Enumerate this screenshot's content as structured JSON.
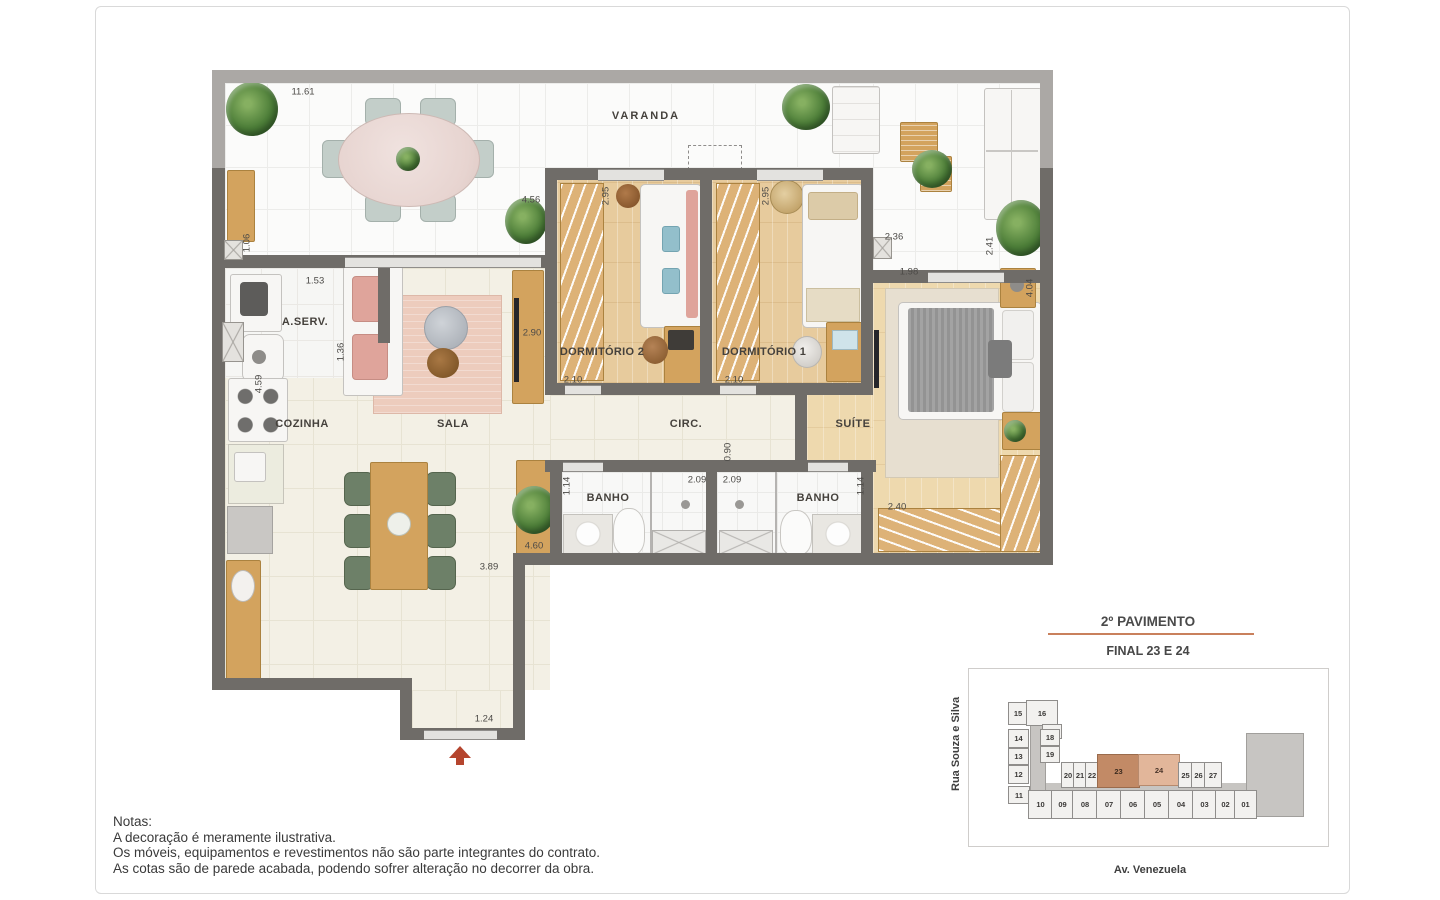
{
  "colors": {
    "wall": "#6f6c68",
    "parapet": "#aba8a5",
    "accent_underline": "#c9805c",
    "unit_dark": "#c28a66",
    "unit_light": "#e2b69a",
    "entry_arrow": "#b5452e"
  },
  "plan": {
    "room_labels": [
      {
        "id": "varanda",
        "text": "VARANDA",
        "x": 646,
        "y": 116,
        "ls": 2
      },
      {
        "id": "aserv",
        "text": "A.SERV.",
        "x": 305,
        "y": 322,
        "ls": 0.5
      },
      {
        "id": "cozinha",
        "text": "COZINHA",
        "x": 302,
        "y": 424,
        "ls": 0.5
      },
      {
        "id": "sala",
        "text": "SALA",
        "x": 453,
        "y": 424,
        "ls": 0.5
      },
      {
        "id": "dormitorio-2",
        "text": "DORMITÓRIO 2",
        "x": 602,
        "y": 352,
        "ls": 0.3
      },
      {
        "id": "dormitorio-1",
        "text": "DORMITÓRIO 1",
        "x": 764,
        "y": 352,
        "ls": 0.3
      },
      {
        "id": "circ",
        "text": "CIRC.",
        "x": 686,
        "y": 424,
        "ls": 0.5
      },
      {
        "id": "suite",
        "text": "SUÍTE",
        "x": 853,
        "y": 424,
        "ls": 0.5
      },
      {
        "id": "banho-1",
        "text": "BANHO",
        "x": 608,
        "y": 498,
        "ls": 0.5
      },
      {
        "id": "banho-2",
        "text": "BANHO",
        "x": 818,
        "y": 498,
        "ls": 0.5
      }
    ],
    "dimensions": [
      {
        "text": "11.61",
        "x": 303,
        "y": 92,
        "v": false
      },
      {
        "text": "4.56",
        "x": 531,
        "y": 200,
        "v": false
      },
      {
        "text": "1.06",
        "x": 247,
        "y": 243,
        "v": true
      },
      {
        "text": "1.53",
        "x": 315,
        "y": 281,
        "v": false
      },
      {
        "text": "1.36",
        "x": 341,
        "y": 352,
        "v": true
      },
      {
        "text": "4.59",
        "x": 259,
        "y": 384,
        "v": true
      },
      {
        "text": "2.90",
        "x": 532,
        "y": 333,
        "v": false
      },
      {
        "text": "2.95",
        "x": 606,
        "y": 196,
        "v": true
      },
      {
        "text": "2.95",
        "x": 766,
        "y": 196,
        "v": true
      },
      {
        "text": "2.10",
        "x": 573,
        "y": 380,
        "v": false
      },
      {
        "text": "2.10",
        "x": 734,
        "y": 380,
        "v": false
      },
      {
        "text": "2.36",
        "x": 894,
        "y": 237,
        "v": false
      },
      {
        "text": "2.41",
        "x": 990,
        "y": 246,
        "v": true
      },
      {
        "text": "1.98",
        "x": 909,
        "y": 272,
        "v": false
      },
      {
        "text": "4.04",
        "x": 1030,
        "y": 288,
        "v": true
      },
      {
        "text": "0.90",
        "x": 728,
        "y": 452,
        "v": true
      },
      {
        "text": "1.14",
        "x": 567,
        "y": 486,
        "v": true
      },
      {
        "text": "2.09",
        "x": 697,
        "y": 480,
        "v": false
      },
      {
        "text": "2.09",
        "x": 732,
        "y": 480,
        "v": false
      },
      {
        "text": "1.14",
        "x": 861,
        "y": 486,
        "v": true
      },
      {
        "text": "2.40",
        "x": 897,
        "y": 507,
        "v": false
      },
      {
        "text": "4.60",
        "x": 534,
        "y": 546,
        "v": false
      },
      {
        "text": "3.89",
        "x": 489,
        "y": 567,
        "v": false
      },
      {
        "text": "1.24",
        "x": 484,
        "y": 719,
        "v": false
      }
    ]
  },
  "notes": {
    "title": "Notas:",
    "lines": [
      "A decoração é meramente ilustrativa.",
      "Os móveis, equipamentos e revestimentos não são parte integrantes do contrato.",
      "As cotas são de parede acabada, podendo sofrer alteração no decorrer da obra."
    ]
  },
  "keyplan": {
    "title": "2º PAVIMENTO",
    "subtitle": "FINAL 23 E 24",
    "street_left": "Rua Souza e Silva",
    "street_bottom": "Av. Venezuela",
    "units": [
      {
        "label": "15",
        "x": 1008,
        "y": 702,
        "w": 18,
        "h": 21
      },
      {
        "label": "16",
        "x": 1026,
        "y": 700,
        "w": 30,
        "h": 24
      },
      {
        "label": "17",
        "x": 1042,
        "y": 724,
        "w": 18,
        "h": 13
      },
      {
        "label": "14",
        "x": 1008,
        "y": 729,
        "w": 19,
        "h": 17
      },
      {
        "label": "18",
        "x": 1040,
        "y": 729,
        "w": 18,
        "h": 15
      },
      {
        "label": "13",
        "x": 1008,
        "y": 748,
        "w": 19,
        "h": 15
      },
      {
        "label": "19",
        "x": 1040,
        "y": 746,
        "w": 18,
        "h": 15
      },
      {
        "label": "12",
        "x": 1008,
        "y": 765,
        "w": 19,
        "h": 17
      },
      {
        "label": "11",
        "x": 1008,
        "y": 786,
        "w": 20,
        "h": 16
      },
      {
        "label": "20",
        "x": 1061,
        "y": 762,
        "w": 12,
        "h": 24
      },
      {
        "label": "21",
        "x": 1073,
        "y": 762,
        "w": 12,
        "h": 24
      },
      {
        "label": "22",
        "x": 1085,
        "y": 762,
        "w": 12,
        "h": 24
      },
      {
        "label": "23",
        "x": 1097,
        "y": 754,
        "w": 41,
        "h": 32,
        "hl": "dark"
      },
      {
        "label": "24",
        "x": 1138,
        "y": 754,
        "w": 40,
        "h": 30,
        "hl": "light"
      },
      {
        "label": "25",
        "x": 1178,
        "y": 762,
        "w": 13,
        "h": 24
      },
      {
        "label": "26",
        "x": 1191,
        "y": 762,
        "w": 13,
        "h": 24
      },
      {
        "label": "27",
        "x": 1204,
        "y": 762,
        "w": 16,
        "h": 24
      },
      {
        "label": "10",
        "x": 1028,
        "y": 790,
        "w": 23,
        "h": 27
      },
      {
        "label": "09",
        "x": 1051,
        "y": 790,
        "w": 21,
        "h": 27
      },
      {
        "label": "08",
        "x": 1072,
        "y": 790,
        "w": 24,
        "h": 27
      },
      {
        "label": "07",
        "x": 1096,
        "y": 790,
        "w": 24,
        "h": 27
      },
      {
        "label": "06",
        "x": 1120,
        "y": 790,
        "w": 24,
        "h": 27
      },
      {
        "label": "05",
        "x": 1144,
        "y": 790,
        "w": 24,
        "h": 27
      },
      {
        "label": "04",
        "x": 1168,
        "y": 790,
        "w": 24,
        "h": 27
      },
      {
        "label": "03",
        "x": 1192,
        "y": 790,
        "w": 23,
        "h": 27
      },
      {
        "label": "02",
        "x": 1215,
        "y": 790,
        "w": 19,
        "h": 27
      },
      {
        "label": "01",
        "x": 1234,
        "y": 790,
        "w": 21,
        "h": 27
      }
    ]
  }
}
